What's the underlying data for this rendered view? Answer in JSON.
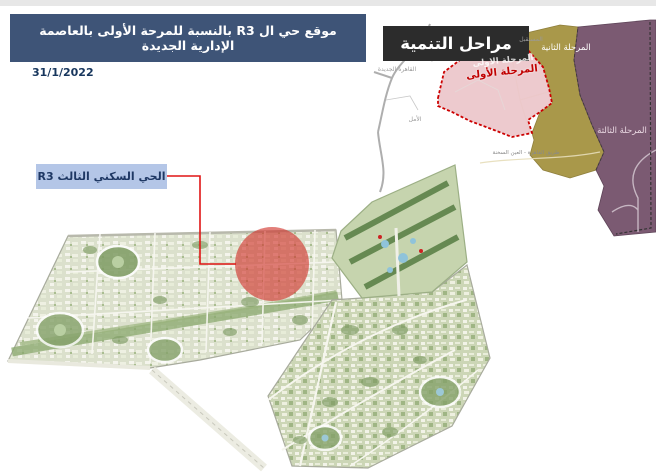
{
  "banner": {
    "title": "موقع حي ال R3 بالنسبة للمرحة الأولى بالعاصمة الإدارية الجديدة",
    "bg": "#3e5477",
    "text_color": "#ffffff"
  },
  "date": {
    "value": "31/1/2022",
    "color": "#17365d"
  },
  "callout": {
    "label": "الحي السكني الثالث R3",
    "bg": "#b4c6e7",
    "text_color": "#1f3864",
    "line_color": "#e01515"
  },
  "inset_map": {
    "title": "مراحل التنمية",
    "title_bg": "#2c2c2c",
    "title_color": "#ffffff",
    "phases": [
      {
        "name": "phase-1",
        "label": "المرحلة الأولى",
        "ghost_label": "المرحلة الاولى",
        "color": "#ecc6ca",
        "border": "#cc0000",
        "label_color": "#c00000"
      },
      {
        "name": "phase-2",
        "label": "المرحلة الثانية",
        "color": "#a9984a",
        "label_color": "#ffffff"
      },
      {
        "name": "phase-3",
        "label": "المرحلة الثالثة",
        "color": "#7b5a72",
        "label_color": "#ead9e3"
      }
    ],
    "background_labels": [
      "المستقبل",
      "القاهرة الجديدة",
      "الأمل"
    ],
    "road_label": "طريق القاهرة - العين السخنة"
  },
  "main_map": {
    "highlight_color": "#d03028",
    "base_color": "#e2e5d6",
    "urban_color": "#dbe0cc",
    "urban2_color": "#ccd6b6",
    "park_color": "#8aa86d",
    "water_color": "#8fc3da",
    "road_color": "#f6f6ee"
  },
  "page": {
    "top_strip_color": "#e7e7e7"
  }
}
